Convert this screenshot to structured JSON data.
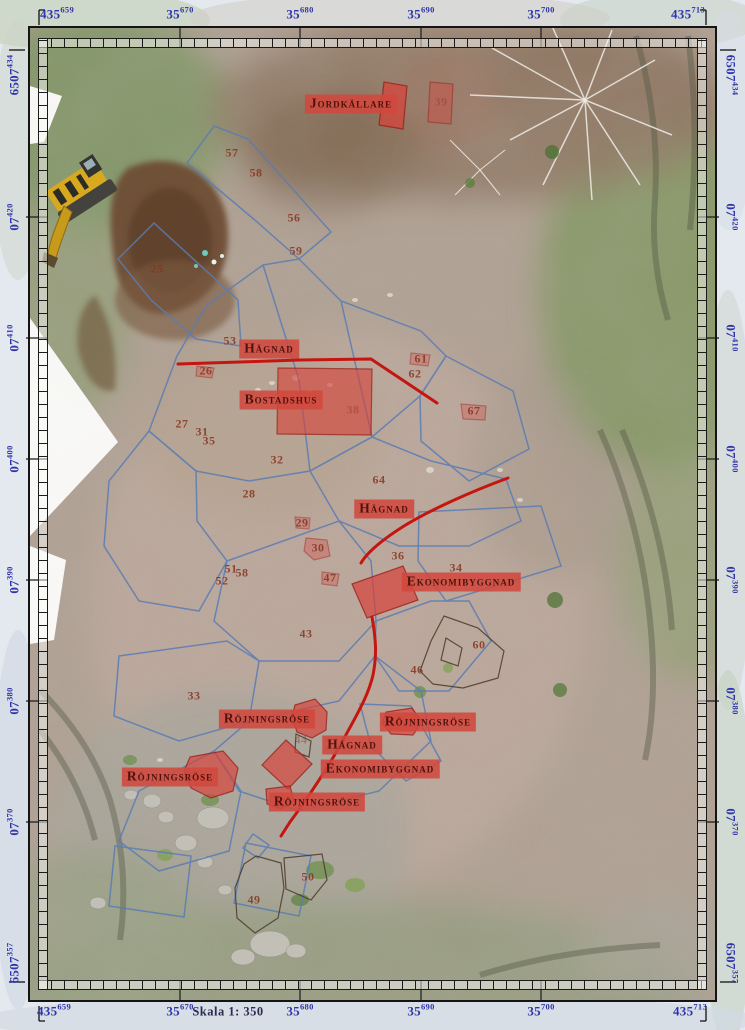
{
  "map": {
    "scale_label": "Skala 1: 350",
    "colors": {
      "coordinate_text": "#2f35a8",
      "label_background": "#d2483e",
      "label_text": "#4d130c",
      "number_text": "#86341f",
      "survey_outline_blue": "#5a7cb3",
      "hagnad_line_red": "#c41510",
      "feature_fill_red": "#d7423a",
      "enclosure_outline_dark": "#4a3a28"
    },
    "coordinates": {
      "top": [
        {
          "main": "435",
          "sup": "659",
          "x": 57,
          "corner": true
        },
        {
          "main": "35",
          "sup": "670",
          "x": 180
        },
        {
          "main": "35",
          "sup": "680",
          "x": 300
        },
        {
          "main": "35",
          "sup": "690",
          "x": 421
        },
        {
          "main": "35",
          "sup": "700",
          "x": 541
        },
        {
          "main": "435",
          "sup": "713",
          "x": 688,
          "corner": true
        }
      ],
      "bottom": [
        {
          "main": "435",
          "sup": "659",
          "x": 54,
          "corner": true
        },
        {
          "main": "35",
          "sup": "670",
          "x": 180
        },
        {
          "main": "35",
          "sup": "680",
          "x": 300
        },
        {
          "main": "35",
          "sup": "690",
          "x": 421
        },
        {
          "main": "35",
          "sup": "700",
          "x": 541
        },
        {
          "main": "435",
          "sup": "713",
          "x": 690,
          "corner": true
        }
      ],
      "left": [
        {
          "main": "6507",
          "sup": "434",
          "y": 75,
          "corner": true
        },
        {
          "main": "07",
          "sup": "420",
          "y": 217
        },
        {
          "main": "07",
          "sup": "410",
          "y": 338
        },
        {
          "main": "07",
          "sup": "400",
          "y": 459
        },
        {
          "main": "07",
          "sup": "390",
          "y": 580
        },
        {
          "main": "07",
          "sup": "380",
          "y": 701
        },
        {
          "main": "07",
          "sup": "370",
          "y": 822
        },
        {
          "main": "6507",
          "sup": "357",
          "y": 963,
          "corner": true
        }
      ],
      "right": [
        {
          "main": "6507",
          "sup": "434",
          "y": 75,
          "corner": true
        },
        {
          "main": "07",
          "sup": "420",
          "y": 217
        },
        {
          "main": "07",
          "sup": "410",
          "y": 338
        },
        {
          "main": "07",
          "sup": "400",
          "y": 459
        },
        {
          "main": "07",
          "sup": "390",
          "y": 580
        },
        {
          "main": "07",
          "sup": "380",
          "y": 701
        },
        {
          "main": "07",
          "sup": "370",
          "y": 822
        },
        {
          "main": "6507",
          "sup": "357",
          "y": 963,
          "corner": true
        }
      ]
    },
    "feature_labels": [
      {
        "id": "jordkallare",
        "text": "Jordkällare",
        "x": 351,
        "y": 104
      },
      {
        "id": "hagnad-north",
        "text": "Hägnad",
        "x": 269,
        "y": 349
      },
      {
        "id": "bostadshus",
        "text": "Bostadshus",
        "x": 281,
        "y": 400
      },
      {
        "id": "hagnad-mid",
        "text": "Hägnad",
        "x": 384,
        "y": 509
      },
      {
        "id": "ekonomibyggnad-east",
        "text": "Ekonomibyggnad",
        "x": 461,
        "y": 582
      },
      {
        "id": "rojningsrose-north",
        "text": "Röjningsröse",
        "x": 267,
        "y": 719
      },
      {
        "id": "rojningsrose-east",
        "text": "Röjningsröse",
        "x": 428,
        "y": 722
      },
      {
        "id": "hagnad-south",
        "text": "Hägnad",
        "x": 352,
        "y": 745
      },
      {
        "id": "ekonomibyggnad-south",
        "text": "Ekonomibyggnad",
        "x": 380,
        "y": 769
      },
      {
        "id": "rojningsrose-west",
        "text": "Röjningsröse",
        "x": 170,
        "y": 777
      },
      {
        "id": "rojningsrose-south",
        "text": "Röjningsröse",
        "x": 317,
        "y": 802
      }
    ],
    "site_numbers": [
      {
        "n": "57",
        "x": 232,
        "y": 153
      },
      {
        "n": "58",
        "x": 256,
        "y": 173
      },
      {
        "n": "56",
        "x": 294,
        "y": 218
      },
      {
        "n": "59",
        "x": 296,
        "y": 251
      },
      {
        "n": "25",
        "x": 157,
        "y": 269
      },
      {
        "n": "39",
        "x": 441,
        "y": 102,
        "f": true
      },
      {
        "n": "53",
        "x": 230,
        "y": 341
      },
      {
        "n": "26",
        "x": 206,
        "y": 371
      },
      {
        "n": "61",
        "x": 421,
        "y": 359
      },
      {
        "n": "62",
        "x": 415,
        "y": 374
      },
      {
        "n": "67",
        "x": 474,
        "y": 411
      },
      {
        "n": "27",
        "x": 182,
        "y": 424
      },
      {
        "n": "31",
        "x": 202,
        "y": 432
      },
      {
        "n": "35",
        "x": 209,
        "y": 441
      },
      {
        "n": "32",
        "x": 277,
        "y": 460
      },
      {
        "n": "38",
        "x": 353,
        "y": 410,
        "f": true
      },
      {
        "n": "28",
        "x": 249,
        "y": 494
      },
      {
        "n": "29",
        "x": 302,
        "y": 523
      },
      {
        "n": "30",
        "x": 318,
        "y": 548
      },
      {
        "n": "64",
        "x": 379,
        "y": 480
      },
      {
        "n": "36",
        "x": 398,
        "y": 556
      },
      {
        "n": "34",
        "x": 456,
        "y": 568
      },
      {
        "n": "47",
        "x": 330,
        "y": 578
      },
      {
        "n": "51",
        "x": 231,
        "y": 569
      },
      {
        "n": "58",
        "x": 242,
        "y": 573
      },
      {
        "n": "52",
        "x": 222,
        "y": 581
      },
      {
        "n": "43",
        "x": 306,
        "y": 634
      },
      {
        "n": "46",
        "x": 417,
        "y": 670
      },
      {
        "n": "60",
        "x": 479,
        "y": 645
      },
      {
        "n": "33",
        "x": 194,
        "y": 696
      },
      {
        "n": "44",
        "x": 301,
        "y": 740,
        "f": true
      },
      {
        "n": "50",
        "x": 308,
        "y": 877
      },
      {
        "n": "49",
        "x": 254,
        "y": 900
      }
    ],
    "shapes": {
      "red_fills": [
        {
          "name": "jordkallare-cellar",
          "path": "M384,82 L407,86 L403,129 L379,125 Z",
          "opacity": 0.72
        },
        {
          "name": "cellar-faded",
          "path": "M430,82 L453,84 L451,124 L428,122 Z",
          "opacity": 0.38
        },
        {
          "name": "bostadshus-building",
          "path": "M278,368 L372,369 L371,435 L277,434 Z",
          "opacity": 0.62
        },
        {
          "name": "ekonomibyggnad-building",
          "path": "M352,584 L403,566 L418,600 L367,618 Z",
          "opacity": 0.7
        },
        {
          "name": "rose-north",
          "path": "M295,705 L315,699 L327,712 L326,730 L312,738 L297,732 L292,717 Z",
          "opacity": 0.68
        },
        {
          "name": "rose-diamond",
          "path": "M286,740 L312,764 L288,789 L262,765 Z",
          "opacity": 0.68
        },
        {
          "name": "rose-small",
          "path": "M266,789 L290,786 L294,801 L281,809 L267,804 Z",
          "opacity": 0.68
        },
        {
          "name": "rose-west",
          "path": "M190,757 L223,751 L238,768 L233,791 L211,798 L191,788 L184,771 Z",
          "opacity": 0.68
        },
        {
          "name": "rose-east",
          "path": "M386,712 L412,708 L422,722 L413,735 L391,734 L382,723 Z",
          "opacity": 0.68
        },
        {
          "name": "blob-30",
          "path": "M306,538 L327,540 L330,556 L314,560 L304,551 Z",
          "opacity": 0.32
        },
        {
          "name": "blob-29",
          "path": "M295,517 L310,518 L309,529 L296,528 Z",
          "opacity": 0.28
        },
        {
          "name": "blob-67",
          "path": "M461,404 L486,406 L485,420 L463,419 Z",
          "opacity": 0.3
        },
        {
          "name": "blob-61",
          "path": "M411,353 L430,355 L428,366 L410,364 Z",
          "opacity": 0.28
        },
        {
          "name": "blob-47",
          "path": "M322,572 L339,574 L337,586 L322,584 Z",
          "opacity": 0.3
        },
        {
          "name": "blob-26",
          "path": "M197,366 L214,368 L212,378 L196,376 Z",
          "opacity": 0.28
        }
      ],
      "red_lines": [
        {
          "name": "hagnad-north-line",
          "path": "M178,364 L300,360 L371,359 L437,403"
        },
        {
          "name": "hagnad-mid-line",
          "path": "M508,478 C470,492 430,510 404,526 C385,538 368,551 361,563"
        },
        {
          "name": "hagnad-south-line",
          "path": "M372,617 C376,640 377,655 373,675 C368,697 356,716 341,744 C325,772 310,795 290,822 L281,836"
        }
      ],
      "blue_outlines": [
        "M214,126 L248,139 L331,232 L299,259 L256,221 L187,163 Z",
        "M118,259 L154,223 L238,300 L241,346 L196,339 L151,300 Z",
        "M177,356 L206,306 L263,265 L299,259 L341,301 L421,331 L446,356 L420,396 L372,437 L310,471 L249,481 L196,471 L149,431 Z",
        "M446,356 L513,391 L529,449 L469,481 L421,441 L420,396 Z",
        "M310,471 L372,437 L431,461 L506,479 L521,521 L469,546 L399,546 L339,521 Z",
        "M419,512 L541,506 L561,566 L446,601 L418,561 Z",
        "M149,431 L196,471 L197,521 L227,561 L199,611 L139,601 L104,546 L109,481 Z",
        "M227,561 L339,521 L371,561 L376,621 L339,661 L259,661 L214,621 Z",
        "M376,621 L431,601 L469,601 L491,641 L449,691 L399,691 L375,656 Z",
        "M119,656 L227,641 L259,661 L249,721 L179,741 L114,716 Z",
        "M249,721 L339,701 L375,656 L421,691 L431,741 L379,791 L299,811 L239,791 L214,751 Z",
        "M360,704 L411,706 L441,761 L406,781 L371,746 Z",
        "M139,791 L214,751 L241,791 L229,851 L159,871 L119,841 Z",
        "M246,843 L311,856 L299,916 L234,903 Z",
        "M115,846 L191,856 L184,917 L109,906 Z",
        "M253,834 L269,845 L258,858 L243,848 Z",
        "M263,265 L299,380 L310,471",
        "M341,301 L372,437"
      ],
      "dark_outlines": [
        "M431,641 L444,616 L478,628 L504,651 L498,678 L463,688 L433,684 L420,671 Z",
        "M256,856 L281,863 L284,888 L278,918 L255,933 L237,918 L235,888 L244,864 Z",
        "M284,858 L322,854 L327,880 L311,900 L286,889 Z",
        "M296,734 L311,741 L309,757 L295,752 Z",
        "M446,638 L462,648 L458,666 L441,660 Z"
      ]
    }
  }
}
